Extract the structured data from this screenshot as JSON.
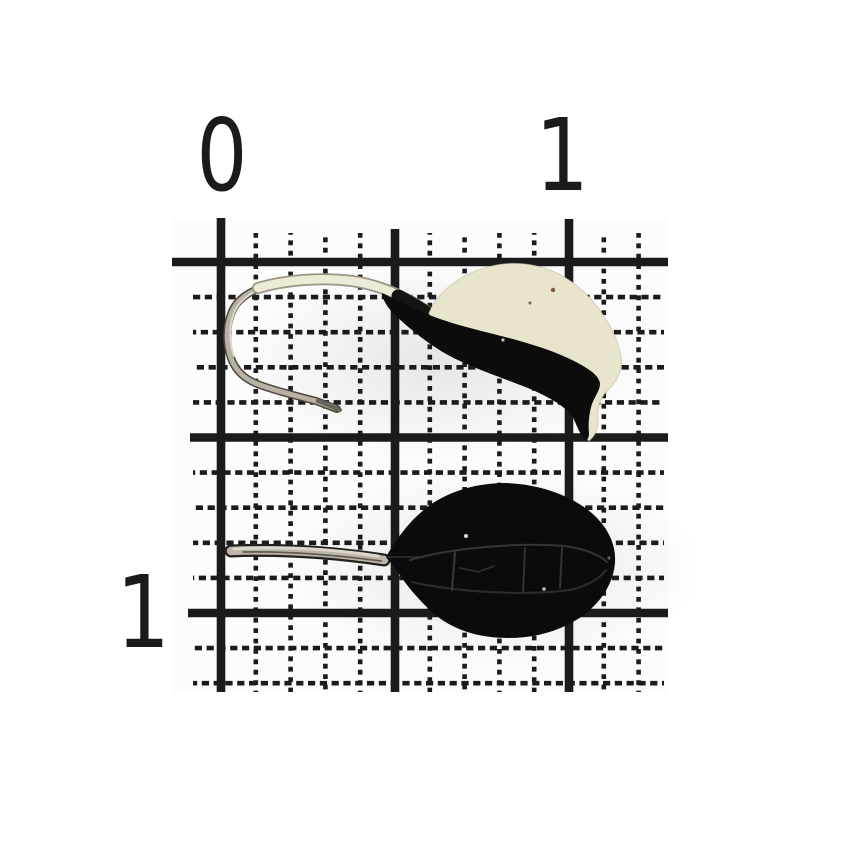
{
  "scene": {
    "description": "Two mormyshka fishing jigs photographed on millimeter graph paper",
    "paper_color": "#ffffff",
    "grid_color": "#1c1c1c",
    "label_color": "#1b1b1b"
  },
  "ruler": {
    "top_labels": [
      {
        "text": "0"
      },
      {
        "text": "1"
      }
    ],
    "side_labels": [
      {
        "text": "1"
      }
    ]
  },
  "objects": {
    "top_jig": {
      "name": "drop-shaped mormyshka, glow white top with black belly and exposed silver hook",
      "body_top_color": "#e9e5cd",
      "body_bottom_color": "#0d0c0a",
      "hook_color": "#b8b1a4",
      "paint_color": "#edead6"
    },
    "bottom_jig": {
      "name": "black oval mormyshka with long wire loop eye",
      "body_color": "#0b0b0b",
      "wire_color": "#bcb5a8"
    }
  }
}
